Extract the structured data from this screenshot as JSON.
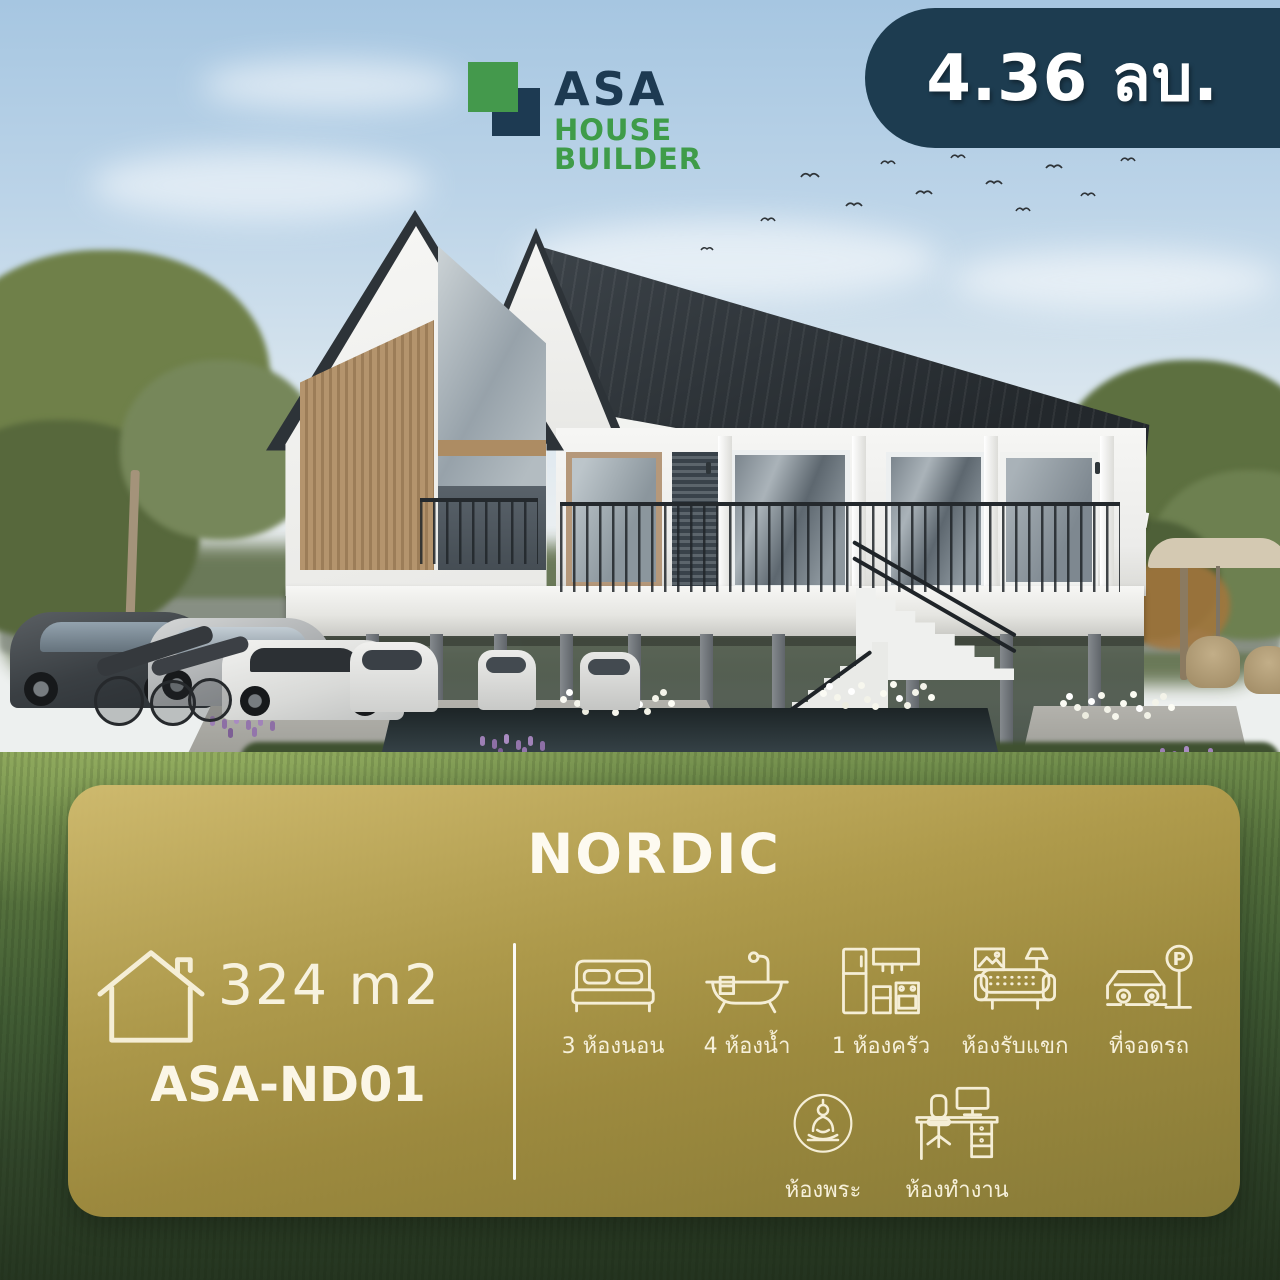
{
  "brand": {
    "name_line1": "ASA",
    "name_line2": "HOUSE BUILDER",
    "green": "#3f9c49",
    "navy": "#1d3a52"
  },
  "price_badge": {
    "text": "4.36 ลบ.",
    "bg_color": "#1d3c50",
    "text_color": "#ffffff"
  },
  "card": {
    "title": "NORDIC",
    "area": "324 m2",
    "model_code": "ASA-ND01",
    "bg_gold_top": "#d0ba6e",
    "bg_gold_bottom": "#92823a",
    "ink_color": "#f6efd8",
    "features_row1": [
      {
        "icon": "bed-icon",
        "label": "3 ห้องนอน"
      },
      {
        "icon": "bathtub-icon",
        "label": "4 ห้องน้ำ"
      },
      {
        "icon": "kitchen-icon",
        "label": "1 ห้องครัว"
      },
      {
        "icon": "sofa-icon",
        "label": "ห้องรับแขก"
      },
      {
        "icon": "parking-icon",
        "label": "ที่จอดรถ"
      }
    ],
    "features_row2": [
      {
        "icon": "buddha-icon",
        "label": "ห้องพระ"
      },
      {
        "icon": "desk-icon",
        "label": "ห้องทำงาน"
      }
    ]
  }
}
